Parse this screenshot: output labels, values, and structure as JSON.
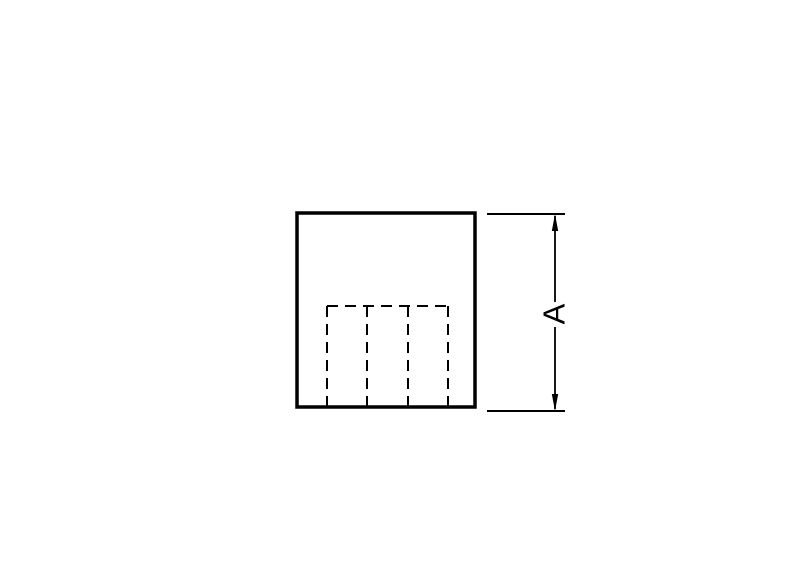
{
  "canvas": {
    "width": 800,
    "height": 576,
    "background": "#ffffff",
    "line_color": "#000000"
  },
  "dimension": {
    "label": "A"
  },
  "diagram": {
    "type": "technical-drawing",
    "viewBox": "0 0 800 576",
    "elements": [
      {
        "name": "part-outline",
        "tag": "rect",
        "attrs": {
          "x": 297,
          "y": 213,
          "width": 178,
          "height": 194,
          "fill": "none",
          "stroke": "#000000",
          "stroke-width": 3.5
        }
      },
      {
        "name": "hidden-line-horizontal",
        "tag": "line",
        "attrs": {
          "x1": 327,
          "y1": 306,
          "x2": 448,
          "y2": 306,
          "stroke": "#000000",
          "stroke-width": 2,
          "stroke-dasharray": "11 7"
        }
      },
      {
        "name": "hidden-line-vertical-1",
        "tag": "line",
        "attrs": {
          "x1": 327,
          "y1": 306,
          "x2": 327,
          "y2": 406,
          "stroke": "#000000",
          "stroke-width": 2,
          "stroke-dasharray": "11 7"
        }
      },
      {
        "name": "hidden-line-vertical-2",
        "tag": "line",
        "attrs": {
          "x1": 367,
          "y1": 306,
          "x2": 367,
          "y2": 406,
          "stroke": "#000000",
          "stroke-width": 2,
          "stroke-dasharray": "11 7"
        }
      },
      {
        "name": "hidden-line-vertical-3",
        "tag": "line",
        "attrs": {
          "x1": 408,
          "y1": 306,
          "x2": 408,
          "y2": 406,
          "stroke": "#000000",
          "stroke-width": 2,
          "stroke-dasharray": "11 7"
        }
      },
      {
        "name": "hidden-line-vertical-4",
        "tag": "line",
        "attrs": {
          "x1": 448,
          "y1": 306,
          "x2": 448,
          "y2": 406,
          "stroke": "#000000",
          "stroke-width": 2,
          "stroke-dasharray": "11 7"
        }
      },
      {
        "name": "extension-line-top",
        "tag": "line",
        "attrs": {
          "x1": 487,
          "y1": 214,
          "x2": 565,
          "y2": 214,
          "stroke": "#000000",
          "stroke-width": 2
        }
      },
      {
        "name": "extension-line-bottom",
        "tag": "line",
        "attrs": {
          "x1": 487,
          "y1": 411,
          "x2": 565,
          "y2": 411,
          "stroke": "#000000",
          "stroke-width": 2
        }
      },
      {
        "name": "dimension-line-upper",
        "tag": "line",
        "attrs": {
          "x1": 555,
          "y1": 216,
          "x2": 555,
          "y2": 302,
          "stroke": "#000000",
          "stroke-width": 1.8
        }
      },
      {
        "name": "dimension-line-lower",
        "tag": "line",
        "attrs": {
          "x1": 555,
          "y1": 327,
          "x2": 555,
          "y2": 409,
          "stroke": "#000000",
          "stroke-width": 1.8
        }
      },
      {
        "name": "dimension-arrow-up-icon",
        "tag": "polygon",
        "attrs": {
          "points": "555,214 551.8,231 558.2,231",
          "fill": "#000000",
          "stroke": "none"
        }
      },
      {
        "name": "dimension-arrow-down-icon",
        "tag": "polygon",
        "attrs": {
          "points": "555,411 551.8,394 558.2,394",
          "fill": "#000000",
          "stroke": "none"
        }
      },
      {
        "name": "dimension-label",
        "tag": "text",
        "attrs": {
          "x": 554,
          "y": 314,
          "transform": "rotate(-90 554 314)",
          "class": "dim-label",
          "dominant-baseline": "central"
        },
        "bind": "dimension.label"
      }
    ]
  }
}
